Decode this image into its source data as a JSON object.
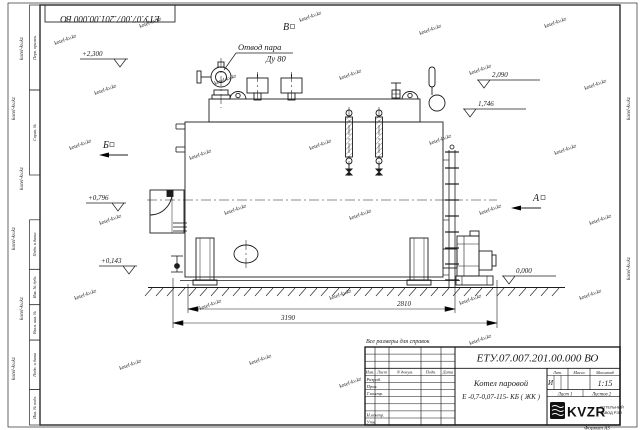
{
  "watermark": {
    "text": "kotel-kv.kz"
  },
  "frame": {
    "doc_number_flipped": "ЕТУ.07.007.201.00.000  ВО",
    "format_label": "Формат А3",
    "margin_labels": {
      "perv": "Перв. примен.",
      "sprav": "Справ. №",
      "podp1": "Подп. и дата",
      "inv_dubl": "Инв. № дубл.",
      "vzam": "Взам. инв. №",
      "podp2": "Подп. и дата",
      "inv_podl": "Инв. № подл."
    }
  },
  "drawing": {
    "note": "Все размеры для справок",
    "callout": {
      "line1": "Отвод пара",
      "line2": "Ду 80"
    },
    "views": {
      "b": "Б",
      "v": "В",
      "a": "А"
    },
    "elevations": {
      "steam_outlet": "+2,300",
      "top_right_upper": "2,090",
      "top_right_lower": "1,746",
      "burner": "+0,796",
      "lower_left": "+0,143",
      "ground": "0,000"
    },
    "dimensions": {
      "body_length": "2810",
      "overall_length": "3190"
    }
  },
  "title_block": {
    "doc_number": "ЕТУ.07.007.201.00.000  ВО",
    "product_name_line1": "Котел паровой",
    "product_name_line2": "Е -0,7-0,07-115- КБ ( ЖК )",
    "columns": {
      "izm": "Изм.",
      "list": "Лист",
      "n_dokum": "N докум.",
      "podp": "Подп.",
      "data": "Дата"
    },
    "rows": {
      "razrab": "Разраб.",
      "prov": "Пров.",
      "tkontr": "Т.контр.",
      "nkontr": "Н.контр.",
      "utv": "Утв."
    },
    "lit_header": "Лит.",
    "massa_header": "Масса",
    "masshtab_header": "Масштаб",
    "lit_value": "И",
    "masshtab_value": "1:15",
    "sheet_label": "Лист 1",
    "sheets_label": "Листов 2",
    "logo_text": "KVZR",
    "logo_caption_line1": "КОТЕЛЬНЫЙ",
    "logo_caption_line2": "ЗАВОД РЭП"
  }
}
